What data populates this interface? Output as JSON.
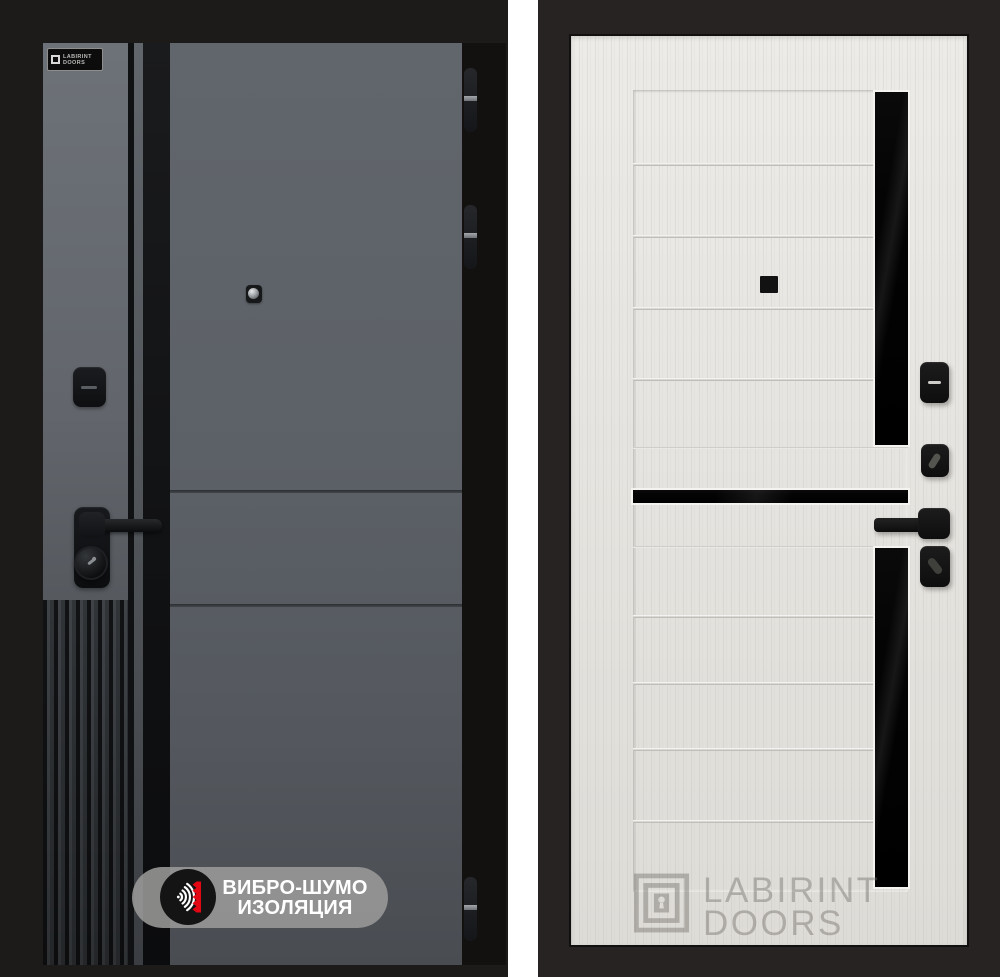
{
  "scene": {
    "left_door": {
      "finish": "graphite grey exterior with black trim",
      "brand_plate": {
        "line1": "LABIRINT",
        "line2": "DOORS"
      },
      "badge": {
        "line1": "ВИБРО-ШУМО",
        "line2": "ИЗОЛЯЦИЯ"
      }
    },
    "right_door": {
      "finish": "light sandal wood interior with black glass inserts",
      "watermark": {
        "line1": "LABIRINT",
        "line2": "DOORS"
      }
    }
  },
  "icons": {
    "badge_icon": "sound-waves-vibration-icon",
    "watermark_icon": "labyrinth-keyhole-icon",
    "left_peephole": "peephole-icon",
    "right_peephole": "peephole-icon"
  },
  "colors": {
    "badge_red": "#e30613",
    "badge_pill": "#9a9a98",
    "graphite": "#5d6268",
    "black_trim": "#131416",
    "light_wood": "#e6e4e0",
    "glass": "#060606",
    "divider": "#ffffff",
    "bg_left": "#1d1b1a",
    "bg_right": "#262322"
  }
}
